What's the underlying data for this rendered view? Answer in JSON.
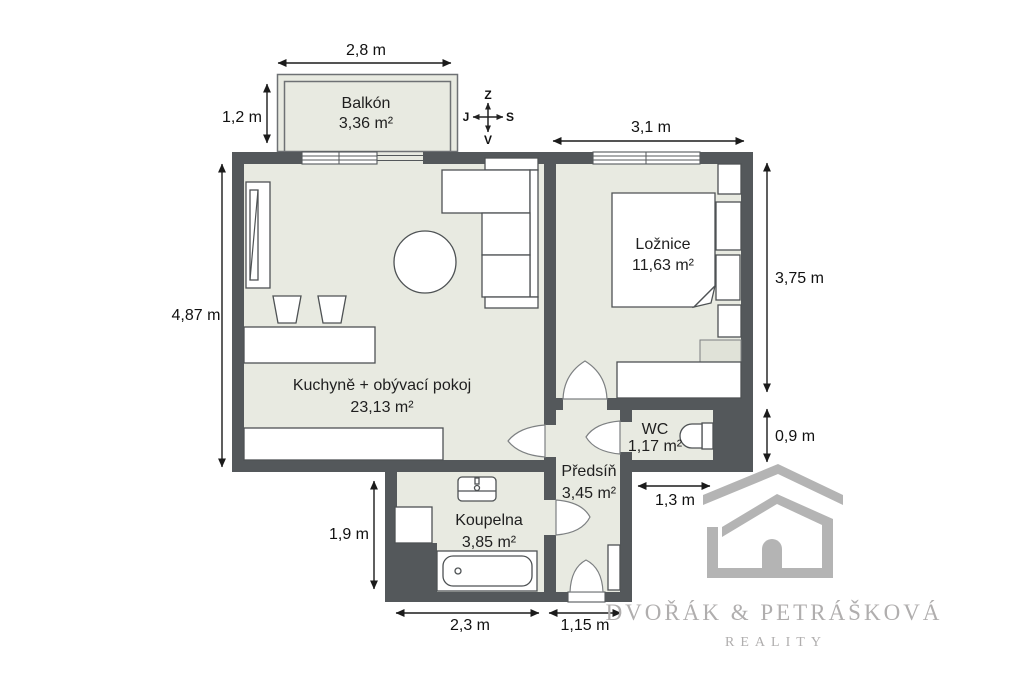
{
  "plan": {
    "rooms": [
      {
        "name": "Balkón",
        "area": "3,36 m²"
      },
      {
        "name": "Ložnice",
        "area": "11,63 m²"
      },
      {
        "name": "Kuchyně + obývací pokoj",
        "area": "23,13 m²"
      },
      {
        "name": "WC",
        "area": "1,17 m²"
      },
      {
        "name": "Předsíň",
        "area": "3,45 m²"
      },
      {
        "name": "Koupelna",
        "area": "3,85 m²"
      }
    ],
    "dimensions": {
      "balcony_width": "2,8 m",
      "balcony_depth": "1,2 m",
      "bedroom_width": "3,1 m",
      "living_height": "4,87 m",
      "bedroom_height": "3,75 m",
      "wc_height": "0,9 m",
      "wc_width": "1,3 m",
      "bathroom_height": "1,9 m",
      "bathroom_width": "2,3 m",
      "hall_width": "1,15 m"
    },
    "compass": {
      "up": "Z",
      "left": "J",
      "right": "S",
      "down": "V"
    },
    "watermark": {
      "line1": "DVOŘÁK & PETRÁŠKOVÁ",
      "line2": "REALITY"
    },
    "colors": {
      "wall": "#54585b",
      "floor": "#e8eae1",
      "dimension_text": "#111111",
      "watermark": "#b4b4b4"
    }
  }
}
